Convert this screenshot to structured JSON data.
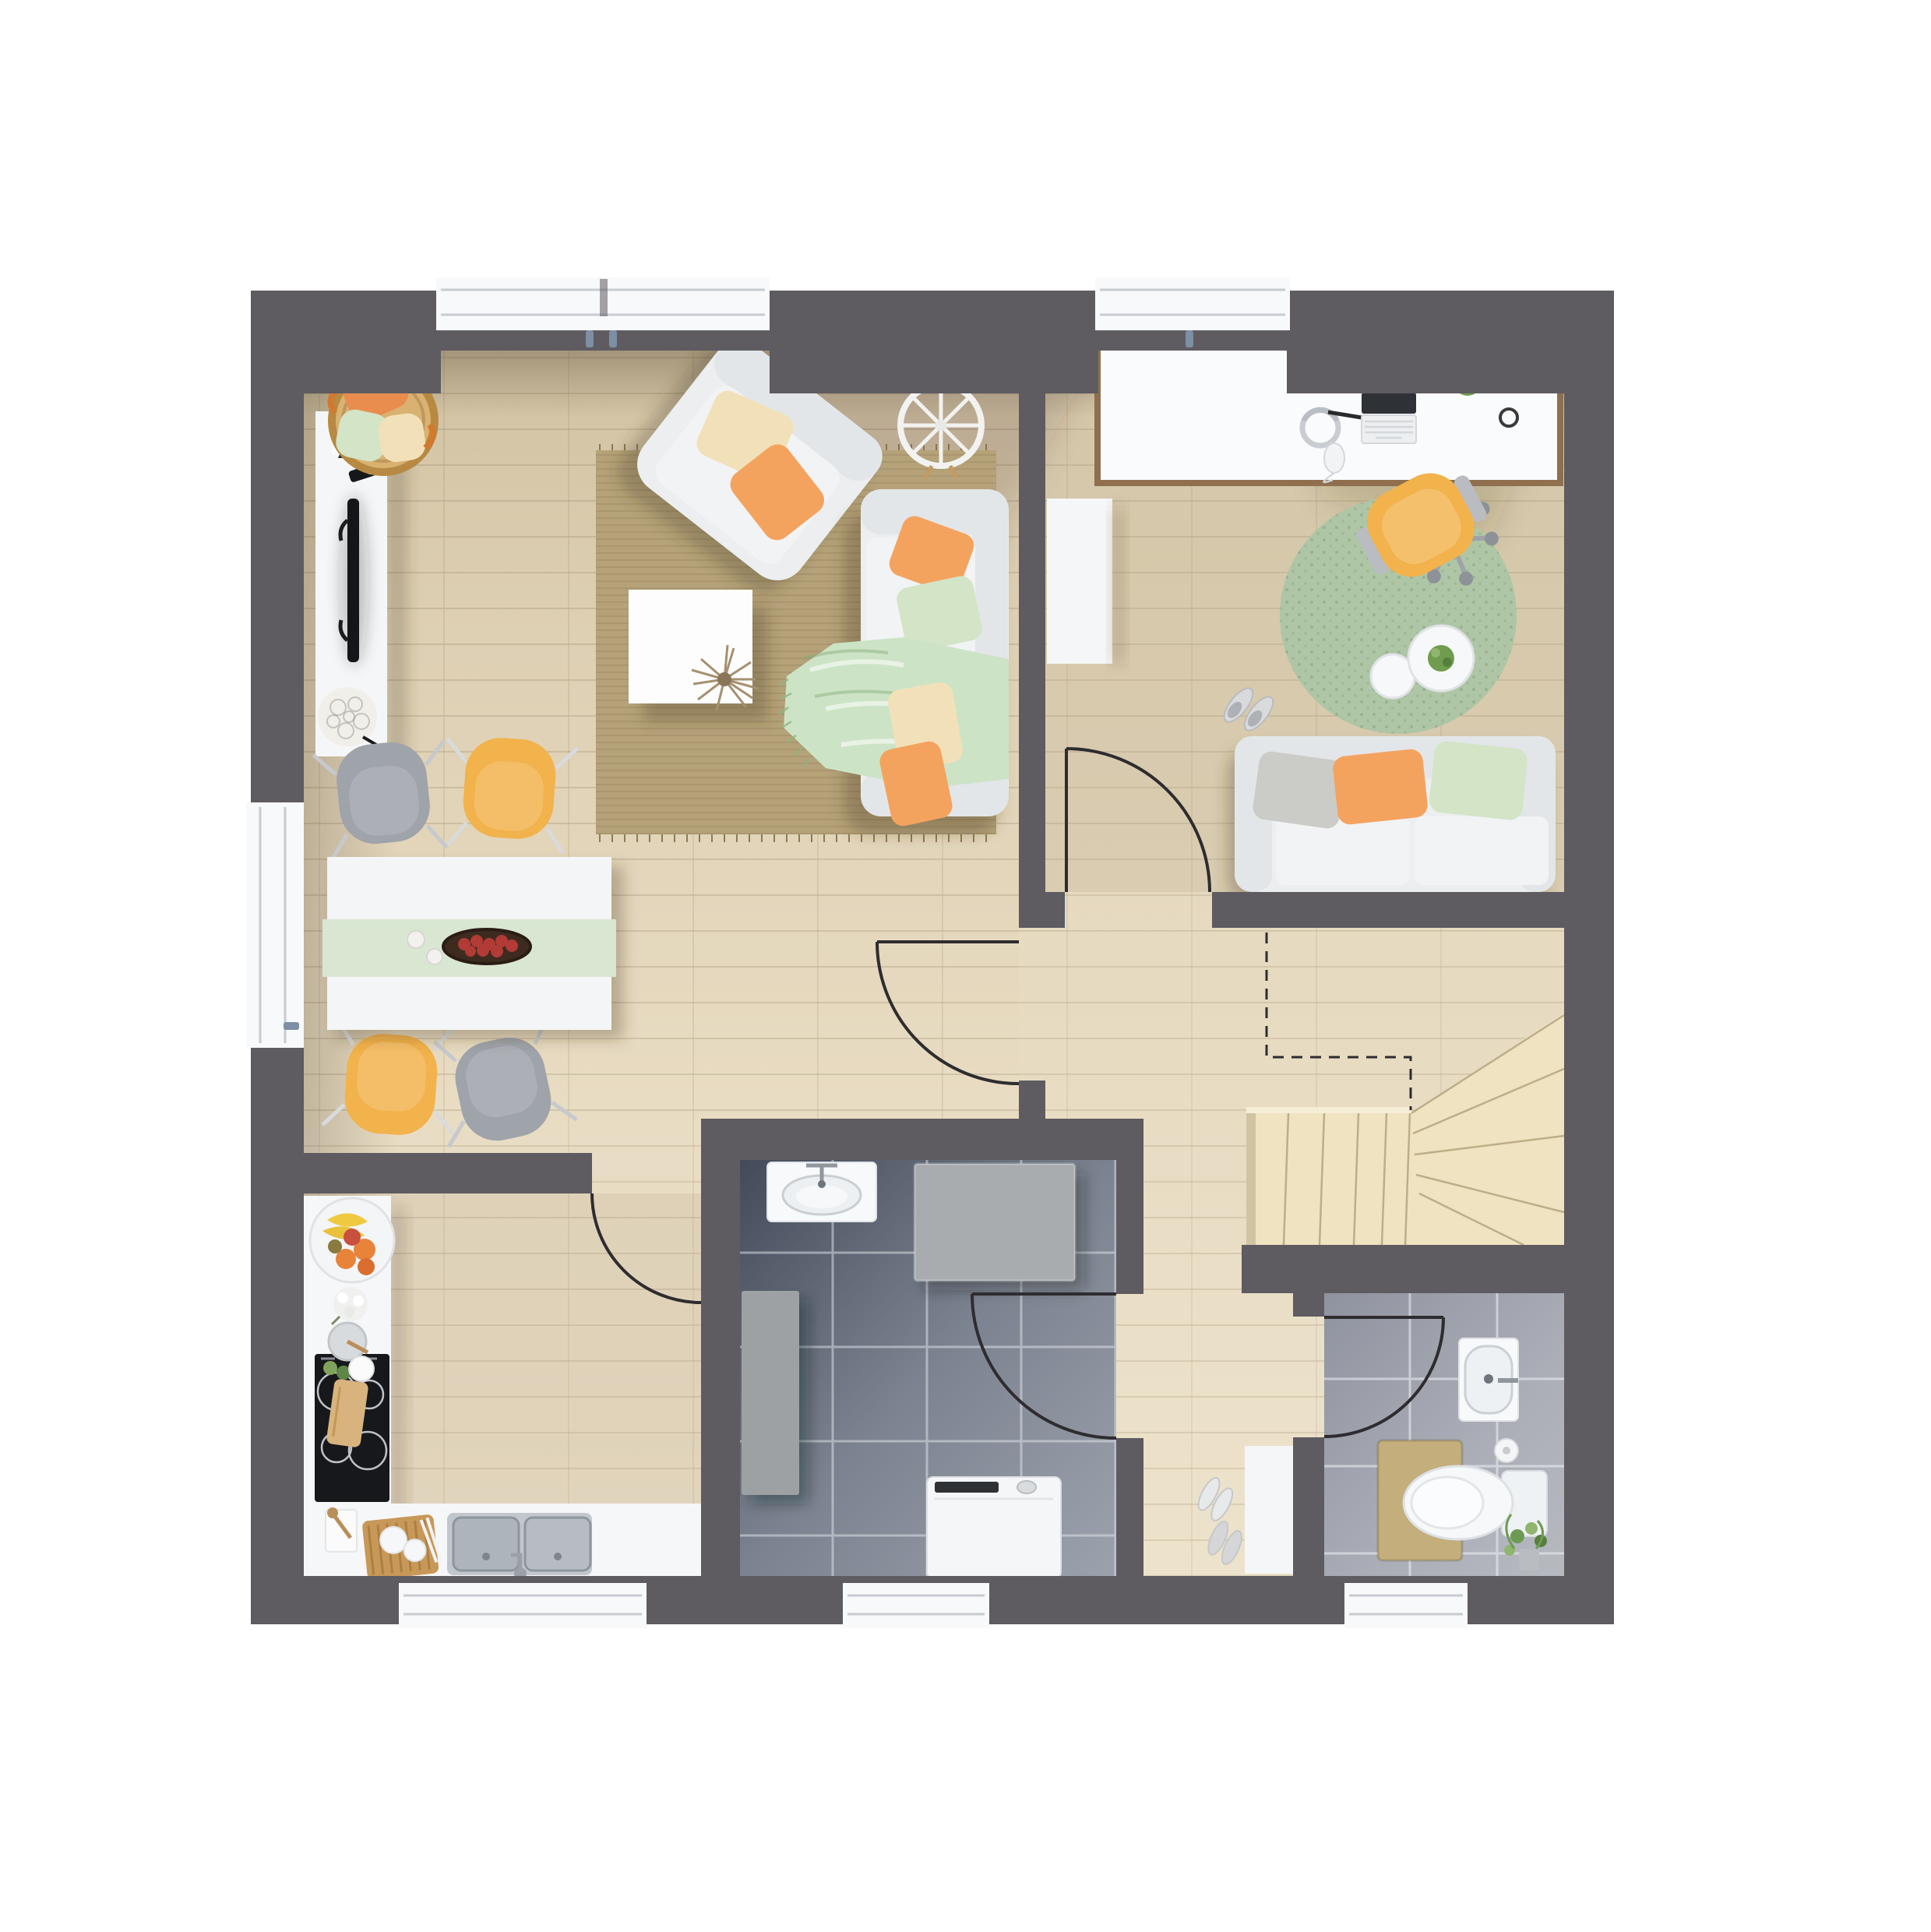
{
  "page": {
    "title": "Rendered apartment floor plan, top view, ground floor"
  },
  "palette": {
    "page_bg": "#FFFFFF",
    "wall": "#5E5B61",
    "floor_base": "#E5D9BF",
    "floor_shade": "#C9B894",
    "window_white": "#F7F9FA",
    "glass_frame": "#C7CCD1",
    "handle": "#7D8FA3",
    "door_line": "#2E2C2F",
    "rug_living": "#B5A279",
    "rug_office": "#AFC6A6",
    "tile_bath_dark": "#4D5564",
    "tile_bath_light": "#9CA2AD",
    "tile_wc_dark": "#999DA8",
    "tile_wc_light": "#B3B6BE",
    "stairs": "#EFE3C1",
    "stairs_light": "#F6EDD6",
    "furniture_white": "#ECEEEF",
    "furniture_white_bright": "#F5F6F7",
    "furniture_seat": "#F1F3F4",
    "furniture_band": "#E3E6E8",
    "counter": "#F6F7F8",
    "cooktop_black": "#17181B",
    "sink_metal": "#C2C7CD",
    "chair_yellow": "#F2B24C",
    "chair_gray": "#9FA3AA",
    "pillow_orange": "#F4A35F",
    "pillow_green": "#D3E4C7",
    "pillow_cream": "#F2E1B8",
    "pillow_gray": "#CBCBC8",
    "throw_mint": "#CDE3C6",
    "runner_mint": "#D9E7D2",
    "basket_tan": "#D9B272",
    "board_wood": "#C89858",
    "desk_trim": "#8F6F4D",
    "plant_green": "#6F9C4E",
    "bowl_brown": "#3E2B20",
    "apple_red": "#B23B35",
    "mat_tan": "#C3AE7C",
    "machine_panel": "#2F3235",
    "shower_gray": "#A9ACAE",
    "cabinet_gray": "#9EA1A4",
    "tv_black": "#141619",
    "remote_teal": "#37C8C2"
  },
  "plan": {
    "rooms": [
      {
        "name": "living-dining-room",
        "furniture": [
          "tv-sideboard",
          "tv",
          "cone-sculpture",
          "remote-control",
          "rose-ball-decor",
          "pillow-basket",
          "armchair",
          "wire-wheel-decor",
          "living-rug",
          "coffee-table",
          "dried-flower",
          "sofa",
          "mint-throw",
          "dining-table",
          "table-runner",
          "fruit-bowl",
          "candles",
          "dining-chairs"
        ]
      },
      {
        "name": "office-room",
        "furniture": [
          "desk",
          "laptop",
          "keyboard",
          "headphones",
          "mouse",
          "desk-plant",
          "coaster",
          "swivel-chair",
          "round-rug",
          "side-tables",
          "table-plant",
          "slippers",
          "office-sofa",
          "wall-cabinet"
        ]
      },
      {
        "name": "kitchen",
        "furniture": [
          "l-counter",
          "induction-cooktop",
          "fruit-plate",
          "flower-decor",
          "prep-bowls",
          "cutting-board",
          "double-sink",
          "faucet",
          "serving-board",
          "towel"
        ]
      },
      {
        "name": "bathroom",
        "furniture": [
          "washbasin",
          "shower-unit",
          "tall-cabinet",
          "washing-machine"
        ]
      },
      {
        "name": "wc",
        "furniture": [
          "wall-sink",
          "toilet",
          "bath-mat",
          "toilet-paper",
          "plant"
        ]
      },
      {
        "name": "hallway",
        "furniture": [
          "shoe-cabinet",
          "shoes"
        ]
      },
      {
        "name": "staircase",
        "furniture": [
          "winder-stairs",
          "upper-flight-dashed-outline"
        ]
      }
    ],
    "doors": [
      "living-room-door",
      "office-door",
      "kitchen-door",
      "bathroom-door",
      "wc-door"
    ],
    "windows": [
      "living-room-double-window",
      "office-window",
      "terrace-door-left",
      "kitchen-window",
      "bathroom-window",
      "wc-window"
    ]
  }
}
